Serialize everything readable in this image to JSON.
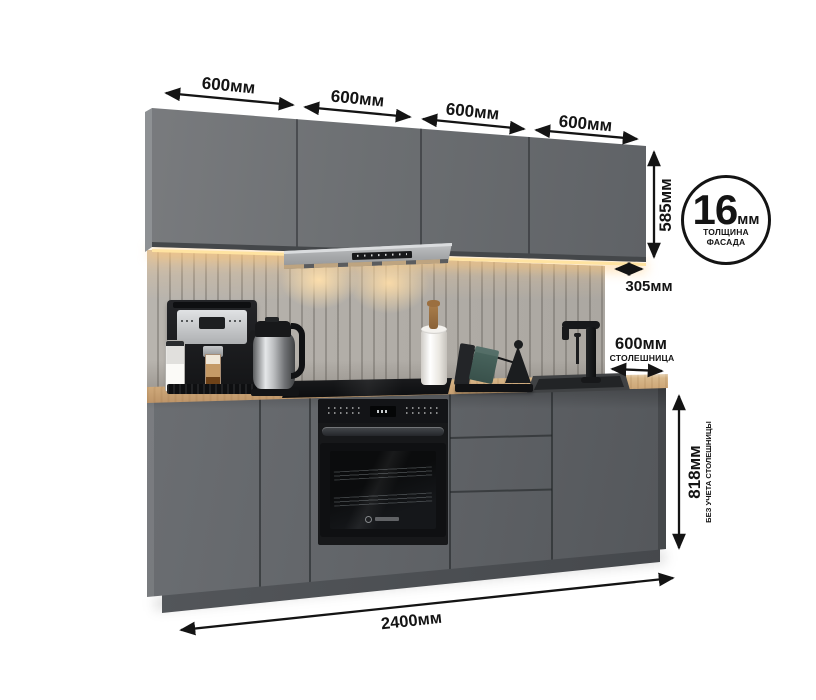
{
  "annotations": {
    "top_widths": [
      "600мм",
      "600мм",
      "600мм",
      "600мм"
    ],
    "upper_height": "585мм",
    "upper_depth": "305мм",
    "badge": {
      "value": "16",
      "unit": "мм",
      "line1": "ТОЛЩИНА",
      "line2": "ФАСАДА"
    },
    "counter_depth": {
      "value": "600мм",
      "caption": "СТОЛЕШНИЦА"
    },
    "base_height": {
      "value": "818мм",
      "caption": "БЕЗ УЧЕТА СТОЛЕШНИЦЫ"
    },
    "total_width": "2400мм"
  },
  "colors": {
    "annotation": "#141414",
    "cabinet_front_upper": "#6c6f72",
    "cabinet_front_base": "#5f6266",
    "countertop_wood": "#cfa97a",
    "backsplash": "#b1ada7",
    "led_glow": "#ffe3a1",
    "hood_silver": "#a8aaac",
    "appliance_black": "#17181a",
    "background": "#ffffff"
  }
}
